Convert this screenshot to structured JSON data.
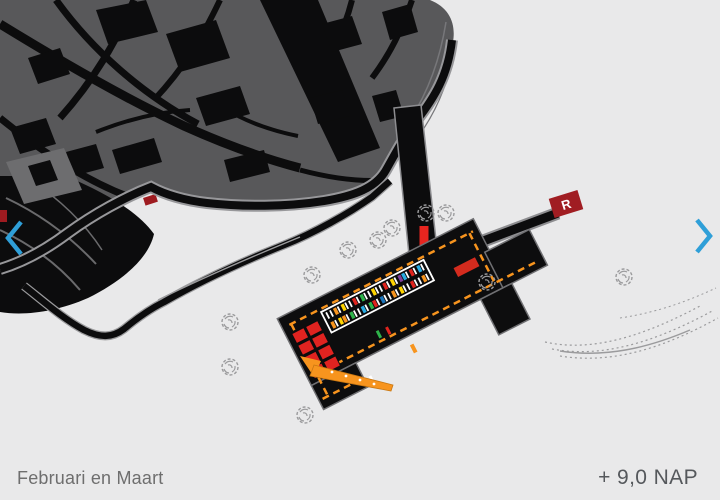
{
  "captions": {
    "period": "Februari en Maart",
    "elevation": "+ 9,0 NAP"
  },
  "nav": {
    "color": "#2f9fd8",
    "prev_icon": "chevron-left",
    "next_icon": "chevron-right"
  },
  "r_marker": {
    "label": "R",
    "color": "#a01d22"
  },
  "palette": {
    "background": "#e9e9ea",
    "map_gray": "#58585a",
    "building_light": "#6d6d6f",
    "ink": "#0c0c0d",
    "road_casing": "#97979a",
    "dash_orange": "#f7941e",
    "container_red": "#e02320",
    "access_red": "#e8251f",
    "map_red": "#9e1b20",
    "tree_gray": "#9b9b9d",
    "caption_gray": "#6e6e6e",
    "elevation_gray": "#55585c"
  },
  "pier": {
    "stall_rows": [
      [
        "#ffffff",
        "#ffffff",
        "#f7941e",
        "#ffffff",
        "#ffd400",
        "#ffffff",
        "#ffffff",
        "#e0241e",
        "#ffffff",
        "#2eb34a",
        "#ffffff",
        "#ffffff",
        "#ffd400",
        "#ffffff",
        "#ffffff",
        "#e0241e",
        "#ffffff",
        "#ffd400",
        "#ffffff",
        "#7f3f98",
        "#29abe2",
        "#ffffff",
        "#e0241e",
        "#ffffff",
        "#29abe2",
        "#ffffff"
      ],
      [
        "#f7941e",
        "#ffffff",
        "#ffd400",
        "#f7941e",
        "#ffffff",
        "#2eb34a",
        "#ffffff",
        "#ffffff",
        "#29abe2",
        "#ffffff",
        "#2eb34a",
        "#e0241e",
        "#ffffff",
        "#1b75bb",
        "#ffffff",
        "#ffffff",
        "#f7941e",
        "#ffffff",
        "#ffd400",
        "#ffffff",
        "#ffffff",
        "#e0241e",
        "#ffffff",
        "#ffffff",
        "#f7941e",
        "#ffffff"
      ]
    ],
    "containers": {
      "rows": 4,
      "cols": 2
    }
  },
  "trees": [
    [
      230,
      322
    ],
    [
      230,
      367
    ],
    [
      305,
      415
    ],
    [
      312,
      275
    ],
    [
      348,
      250
    ],
    [
      378,
      240
    ],
    [
      392,
      228
    ],
    [
      426,
      213
    ],
    [
      446,
      213
    ],
    [
      487,
      282
    ],
    [
      624,
      277
    ]
  ]
}
